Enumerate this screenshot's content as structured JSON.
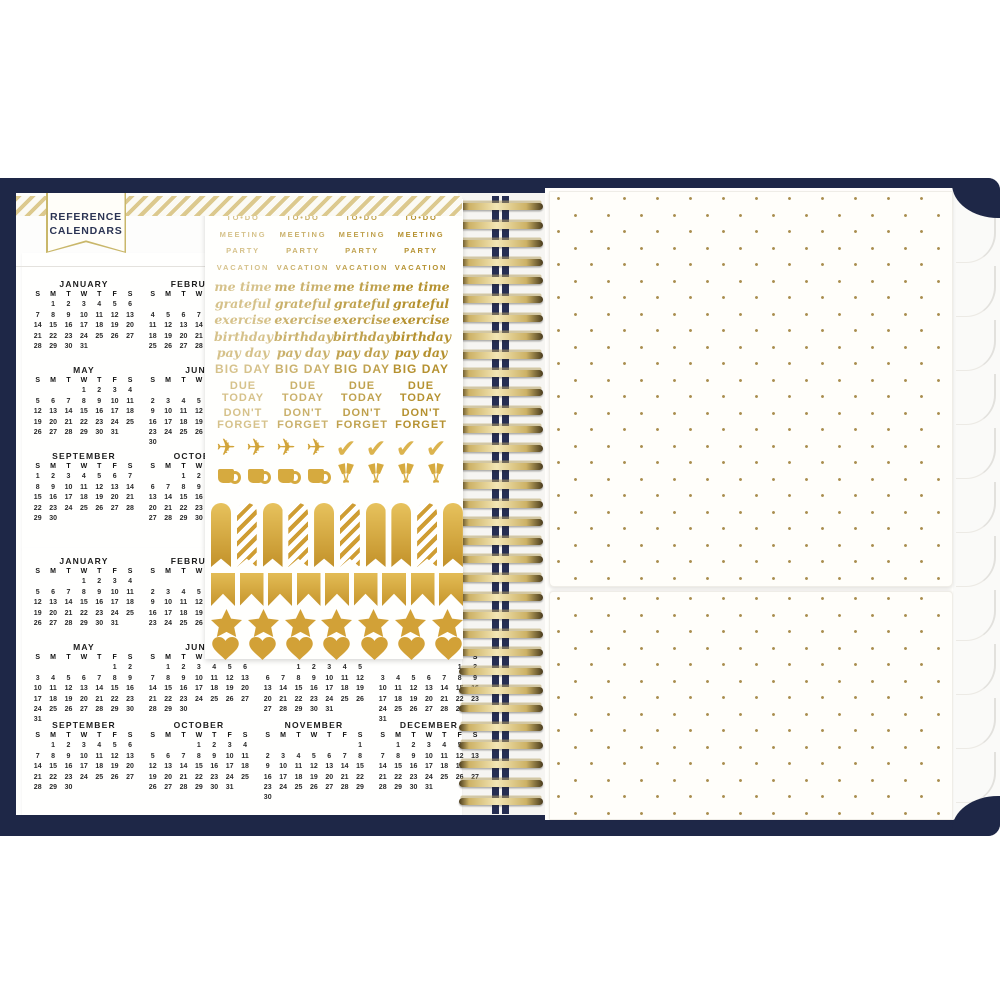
{
  "product": {
    "description": "Open navy spiral planner: reference calendars page, gold word/icon sticker sheet, gold dotted pocket page"
  },
  "banner": {
    "line1": "REFERENCE",
    "line2": "CALENDARS"
  },
  "calendar": {
    "day_headers": [
      "S",
      "M",
      "T",
      "W",
      "T",
      "F",
      "S"
    ],
    "sheet1_months": [
      {
        "name": "JANUARY",
        "start": 1,
        "days": 31,
        "row": 0,
        "col": 0
      },
      {
        "name": "FEBRUARY",
        "start": 4,
        "days": 28,
        "row": 0,
        "col": 1
      },
      {
        "name": "MAY",
        "start": 3,
        "days": 31,
        "row": 1,
        "col": 0
      },
      {
        "name": "JUNE",
        "start": 6,
        "days": 30,
        "row": 1,
        "col": 1
      },
      {
        "name": "SEPTEMBER",
        "start": 0,
        "days": 30,
        "row": 2,
        "col": 0
      },
      {
        "name": "OCTOBER",
        "start": 2,
        "days": 31,
        "row": 2,
        "col": 1
      }
    ],
    "sheet2_months": [
      {
        "name": "JANUARY",
        "start": 3,
        "days": 31,
        "row": 0,
        "col": 0
      },
      {
        "name": "FEBRUARY",
        "start": 6,
        "days": 29,
        "row": 0,
        "col": 1
      },
      {
        "name": "MAY",
        "start": 5,
        "days": 31,
        "row": 1,
        "col": 0
      },
      {
        "name": "JUNE",
        "start": 1,
        "days": 30,
        "row": 1,
        "col": 1
      },
      {
        "name": "JULY",
        "start": 2,
        "days": 31,
        "row": 1,
        "col": 2
      },
      {
        "name": "AUGUST",
        "start": 5,
        "days": 31,
        "row": 1,
        "col": 3
      },
      {
        "name": "SEPTEMBER",
        "start": 1,
        "days": 30,
        "row": 2,
        "col": 0
      },
      {
        "name": "OCTOBER",
        "start": 3,
        "days": 31,
        "row": 2,
        "col": 1
      },
      {
        "name": "NOVEMBER",
        "start": 6,
        "days": 30,
        "row": 2,
        "col": 2
      },
      {
        "name": "DECEMBER",
        "start": 1,
        "days": 31,
        "row": 2,
        "col": 3
      }
    ]
  },
  "stickers": {
    "columns": 4,
    "word_rows": [
      {
        "text": "TO•DO",
        "style": "caps"
      },
      {
        "text": "MEETING",
        "style": "caps"
      },
      {
        "text": "PARTY",
        "style": "caps"
      },
      {
        "text": "VACATION",
        "style": "caps"
      },
      {
        "text": "me time",
        "style": "script"
      },
      {
        "text": "grateful",
        "style": "script"
      },
      {
        "text": "exercise",
        "style": "script"
      },
      {
        "text": "birthday",
        "style": "script"
      },
      {
        "text": "pay day",
        "style": "script"
      },
      {
        "text": "BIG DAY",
        "style": "bold"
      },
      {
        "text": "DUE\nTODAY",
        "style": "bold2"
      },
      {
        "text": "DON'T\nFORGET",
        "style": "bold2"
      }
    ],
    "icon_row_1": [
      "airplane-icon",
      "airplane-icon",
      "airplane-icon",
      "airplane-icon",
      "checkmark-icon",
      "checkmark-icon",
      "checkmark-icon",
      "checkmark-icon"
    ],
    "icon_row_2": [
      "mug-icon",
      "mug-icon",
      "mug-icon",
      "mug-icon",
      "champagne-icon",
      "champagne-icon",
      "champagne-icon",
      "champagne-icon"
    ],
    "strip_pattern": [
      "solid",
      "striped",
      "solid",
      "striped",
      "solid",
      "striped",
      "solid",
      "solid",
      "striped",
      "solid"
    ],
    "flag_count": 9,
    "star_count": 7,
    "heart_count": 7
  },
  "colors": {
    "navy_cover": "#1e2747",
    "gold_foil": "#c3922a",
    "gold_word": "#b5912f",
    "stripe_band": "#dcc98e",
    "dot_gold": "#a98e4e",
    "paper": "#fffffe"
  }
}
